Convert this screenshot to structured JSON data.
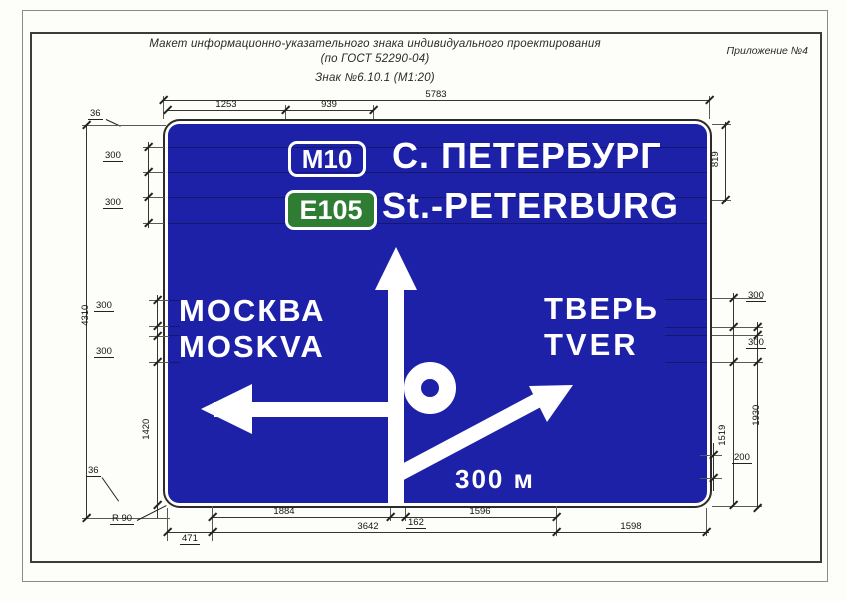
{
  "page": {
    "title_line1": "Макет информационно-указательного знака индивидуального проектирования",
    "title_line2": "(по ГОСТ 52290-04)",
    "title_line3": "Знак №6.10.1 (М1:20)",
    "annex_note": "Приложение №4"
  },
  "sign": {
    "route_number": "M10",
    "destination_primary": "С. ПЕТЕРБУРГ",
    "euro_route": "E105",
    "destination_latin": "St.-PETERBURG",
    "left_destination": "МОСКВА",
    "left_destination_latin": "MOSKVA",
    "right_destination": "ТВЕРЬ",
    "right_destination_latin": "TVER",
    "distance_label": "300 м",
    "colors": {
      "board_blue": "#1c21a8",
      "euro_route_green": "#2f7d33",
      "legend_white": "#ffffff"
    }
  },
  "dimensions": {
    "total_width": "5783",
    "left_offset_to_badge": "1253",
    "badge_width": "939",
    "border_width_top": "36",
    "total_height": "4310",
    "row1_height": "300",
    "row2_height": "300",
    "left_row1_height": "300",
    "left_row2_height": "300",
    "left_lower_height": "1420",
    "border_width_bottom": "36",
    "corner_radius": "R 90",
    "header_height": "819",
    "right_row1_height": "300",
    "right_row2_height": "300",
    "right_outer_height": "1930",
    "right_inner_height": "1519",
    "distance_text_height": "200",
    "arrow_tip_offset": "471",
    "left_arrow_length": "1884",
    "stem_width": "162",
    "diag_arrow_length": "1596",
    "arrows_total_width": "3642",
    "right_segment": "1598"
  }
}
